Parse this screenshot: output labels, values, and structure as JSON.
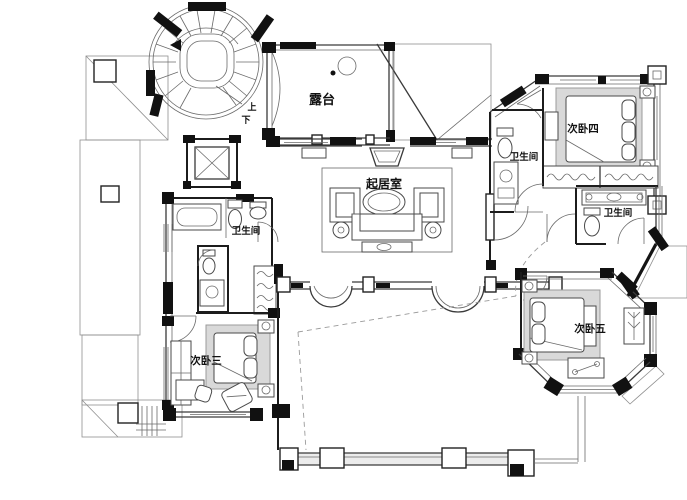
{
  "drawing": {
    "kind": "residential floor plan",
    "labels": {
      "terrace": "露台",
      "living_room": "起居室",
      "bath_left": "卫生间",
      "bath_top_right": "卫生间",
      "bath_right": "卫生间",
      "bedroom3": "次卧三",
      "bedroom4": "次卧四",
      "bedroom5": "次卧五",
      "stair_up": "上",
      "stair_down": "下"
    },
    "colors": {
      "paper": "#ffffff",
      "wall": "#141414",
      "line": "#4a4a4a",
      "hatch": "#b5b5b5",
      "rug": "#d9d9d9"
    }
  }
}
